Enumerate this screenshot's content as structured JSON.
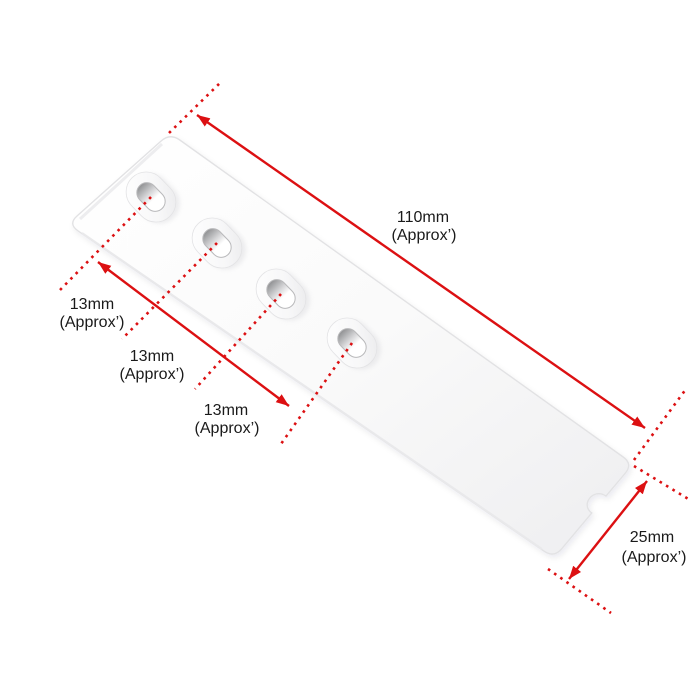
{
  "diagram": {
    "type": "product-dimension-diagram",
    "background": "#ffffff",
    "dimension_color": "#dc1012",
    "label_color": "#1a1a1a"
  },
  "product": {
    "description": "white-plastic-strip-with-4-slots",
    "slot_count": 4,
    "body_color": "#fafafa"
  },
  "labels": {
    "length": {
      "value": "110mm",
      "qualifier": "(Approx’)"
    },
    "spacing1": {
      "value": "13mm",
      "qualifier": "(Approx’)"
    },
    "spacing2": {
      "value": "13mm",
      "qualifier": "(Approx’)"
    },
    "spacing3": {
      "value": "13mm",
      "qualifier": "(Approx’)"
    },
    "width": {
      "value": "25mm",
      "qualifier": "(Approx’)"
    }
  }
}
